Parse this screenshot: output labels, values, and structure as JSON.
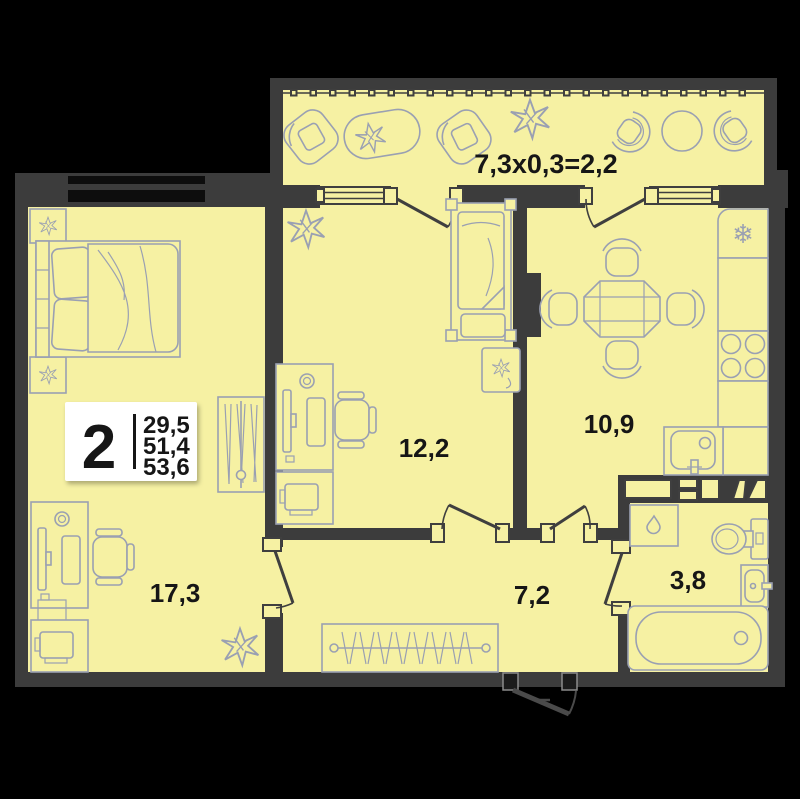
{
  "badge": {
    "rooms": "2",
    "areas": [
      "29,5",
      "51,4",
      "53,6"
    ]
  },
  "room_labels": {
    "bedroom": "17,3",
    "child_room": "12,2",
    "kitchen": "10,9",
    "hallway": "7,2",
    "bathroom": "3,8"
  },
  "balcony_label": "7,3x0,3=2,2",
  "icons": {
    "snowflake": "❄"
  },
  "colors": {
    "background": "#000000",
    "floor": "#f6f1a3",
    "wall": "#3c3c3c",
    "window_glass": "#0d0d0d",
    "furniture": "#9aa0b2",
    "label_text": "#161616",
    "badge_bg": "#ffffff"
  }
}
